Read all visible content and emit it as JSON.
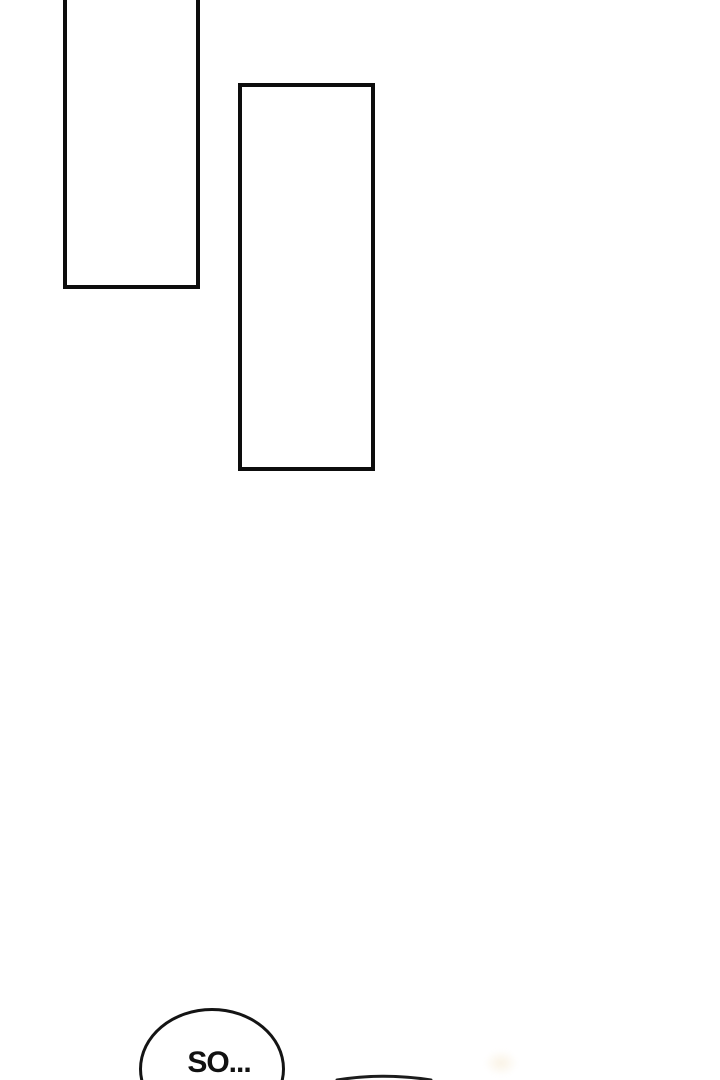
{
  "page": {
    "background_color": "#ffffff"
  },
  "panels": [
    {
      "name": "empty-panel-top-left",
      "border_color": "#0d0d0d",
      "fill_color": "#ffffff"
    },
    {
      "name": "empty-panel-center",
      "border_color": "#0d0d0d",
      "fill_color": "#ffffff"
    }
  ],
  "speech_bubble": {
    "text": "SO...",
    "border_color": "#141414",
    "fill_color": "#ffffff",
    "text_color": "#111111"
  },
  "bottom_edge_art": {
    "arc_color": "#1c1c1c"
  }
}
